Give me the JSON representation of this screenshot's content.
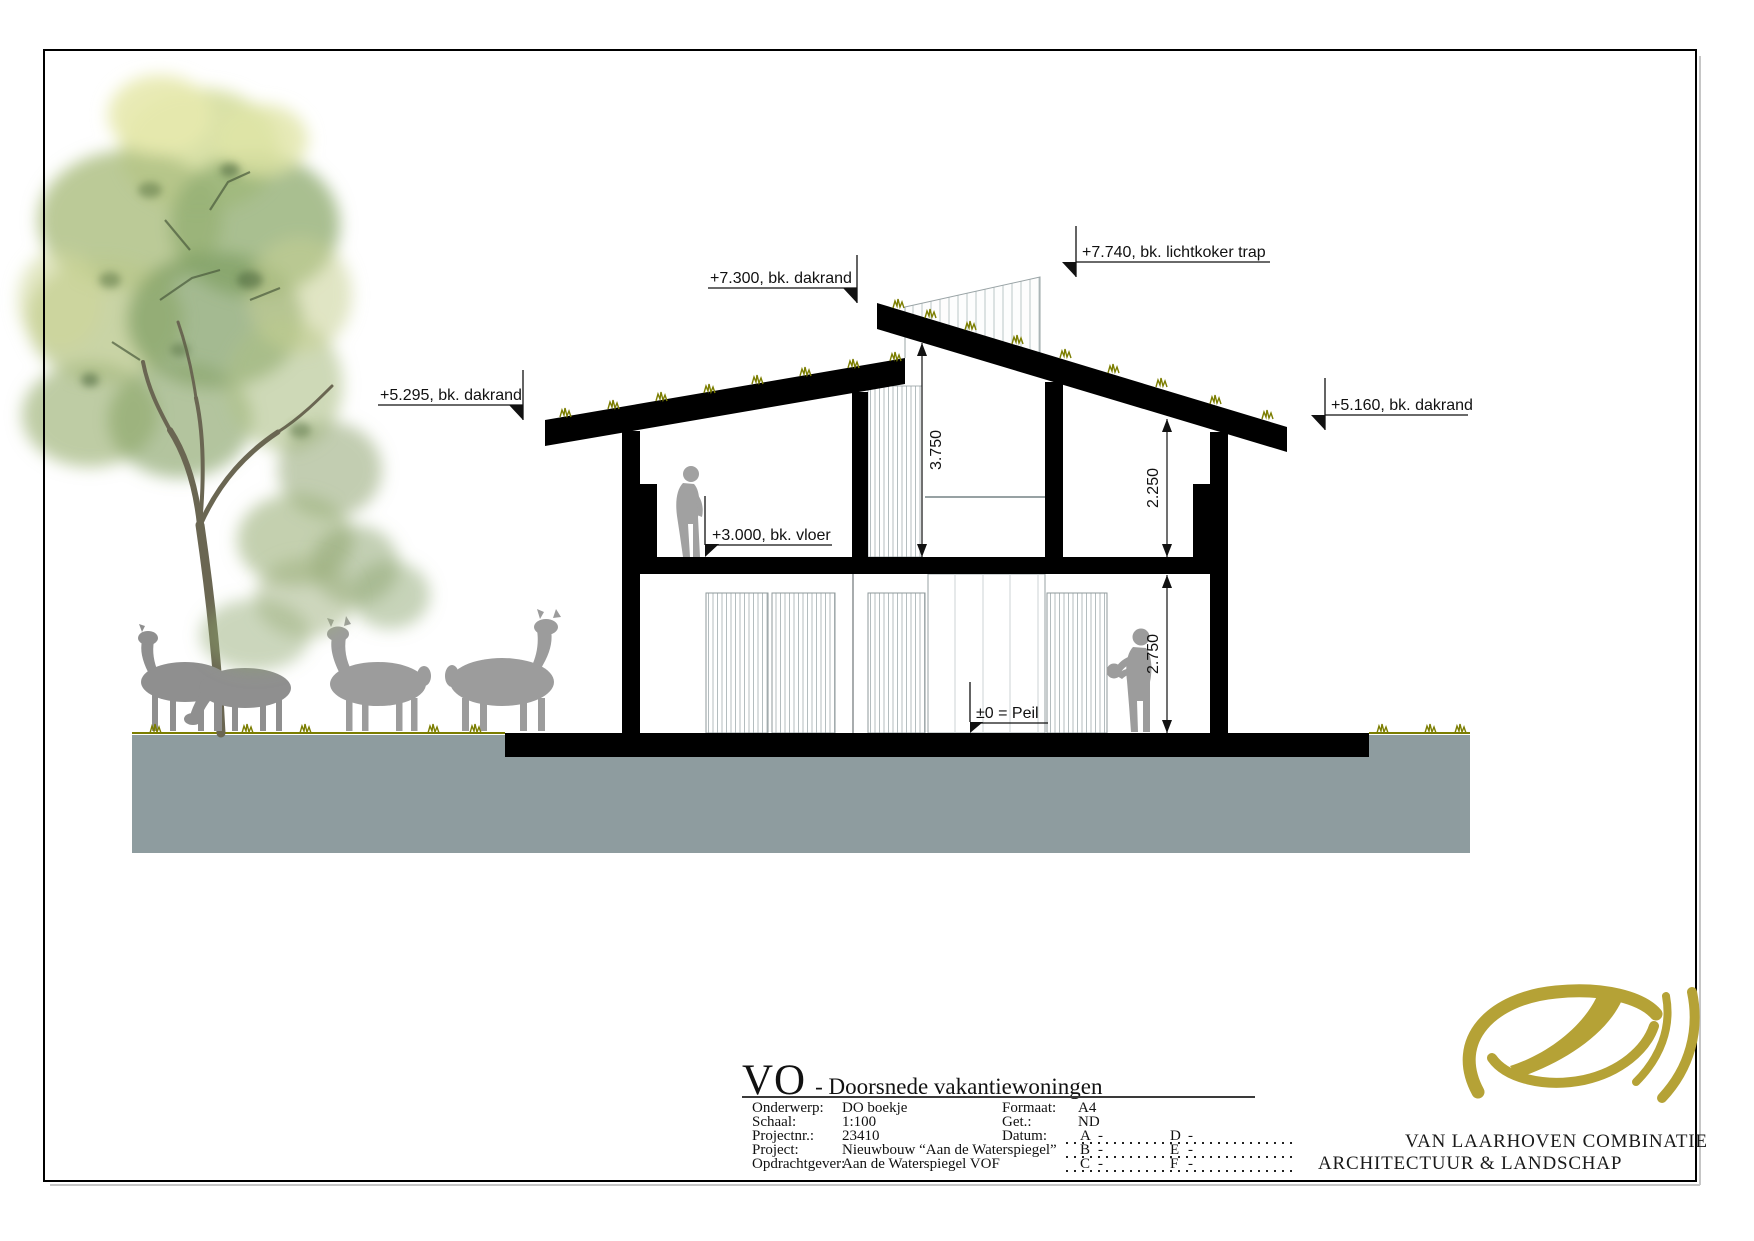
{
  "annotations": {
    "level_dakrand_left": "+5.295, bk. dakrand",
    "level_dakrand_mid": "+7.300, bk. dakrand",
    "level_lichtkoker": "+7.740, bk. lichtkoker trap",
    "level_dakrand_right": "+5.160, bk. dakrand",
    "level_vloer": "+3.000, bk. vloer",
    "level_peil": "±0 = Peil",
    "dim_stairwell": "3.750",
    "dim_upper_floor": "2.250",
    "dim_ground_floor": "2.750"
  },
  "title_block": {
    "drawing_code": "VO",
    "drawing_title": "- Doorsnede vakantiewoningen",
    "fields_left": [
      {
        "label": "Onderwerp:",
        "value": "DO boekje"
      },
      {
        "label": "Schaal:",
        "value": "1:100"
      },
      {
        "label": "Projectnr.:",
        "value": "23410"
      },
      {
        "label": "Project:",
        "value": "Nieuwbouw “Aan de Waterspiegel”"
      },
      {
        "label": "Opdrachtgever:",
        "value": "Aan de Waterspiegel VOF"
      }
    ],
    "fields_right": [
      {
        "label": "Formaat:",
        "value": "A4"
      },
      {
        "label": "Get.:",
        "value": "ND"
      },
      {
        "label": "Datum:",
        "value": ""
      }
    ],
    "revision_letters_col1": [
      "A",
      "B",
      "C"
    ],
    "revision_letters_col2": [
      "D",
      "E",
      "F"
    ],
    "revision_dash": "-"
  },
  "logo": {
    "company_line1": "VAN LAARHOVEN COMBINATIE",
    "company_line2": "ARCHITECTUUR & LANDSCHAP"
  },
  "colors": {
    "structure": "#000000",
    "ground": "#8e9c9f",
    "grass": "#7b7d00",
    "silhouette": "#9c9c9c",
    "hatch_border": "#8f999b",
    "logo_gold": "#b5a236"
  }
}
